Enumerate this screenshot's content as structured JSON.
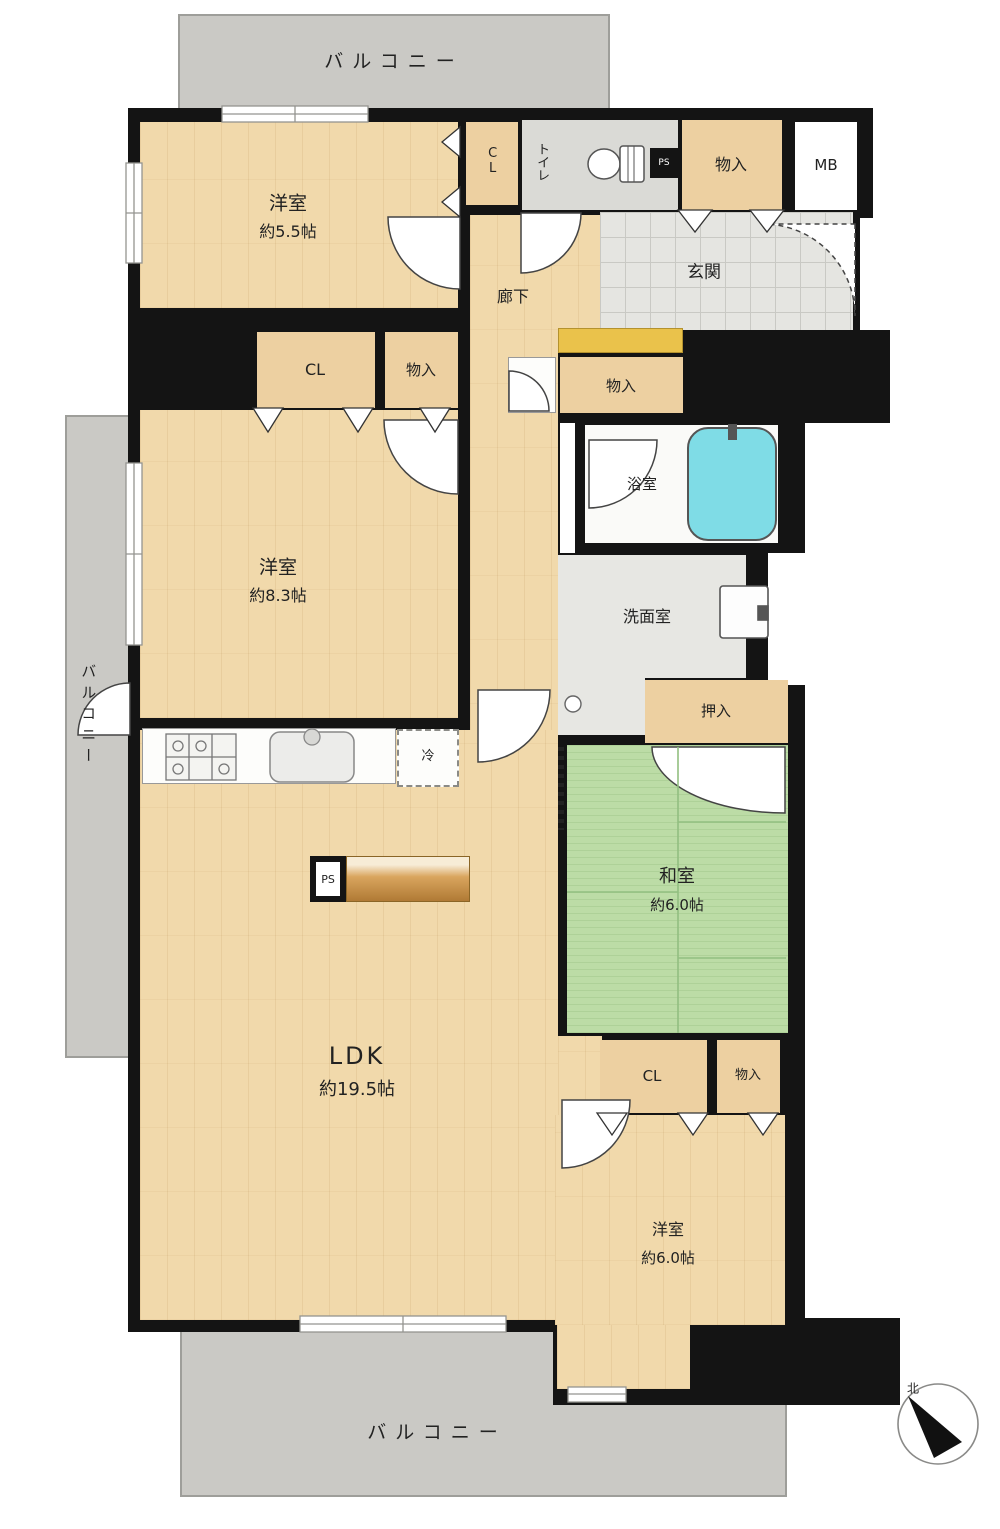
{
  "balconies": {
    "top": "バルコニー",
    "left": "バルコニー",
    "bottom": "バルコニー"
  },
  "rooms": {
    "western_5_5": {
      "label": "洋室",
      "size": "約5.5帖"
    },
    "western_8_3": {
      "label": "洋室",
      "size": "約8.3帖"
    },
    "western_6_0": {
      "label": "洋室",
      "size": "約6.0帖"
    },
    "japanese_6_0": {
      "label": "和室",
      "size": "約6.0帖"
    },
    "ldk": {
      "label": "LDK",
      "size": "約19.5帖"
    },
    "entrance": {
      "label": "玄関"
    },
    "hallway": {
      "label": "廊下"
    },
    "bathroom": {
      "label": "浴室"
    },
    "washroom": {
      "label": "洗面室"
    },
    "toilet": {
      "label": "トイレ"
    }
  },
  "storage": {
    "cl_small": "CL",
    "cl_west83": "CL",
    "cl_west60": "CL",
    "monoire_top": "物入",
    "monoire_hall": "物入",
    "monoire_west83": "物入",
    "monoire_west60": "物入",
    "oshiire": "押入",
    "mb": "MB"
  },
  "fixtures": {
    "fridge": "冷",
    "ps_kitchen": "PS",
    "ps_toilet": "PS"
  },
  "compass": {
    "north": "北"
  },
  "colors": {
    "wall": "#141414",
    "wood": "#f1d9ab",
    "closet": "#edd0a1",
    "tatami": "#bcdca6",
    "tile": "#e5e5e1",
    "balcony": "#cac9c5",
    "accent_step": "#eac24b",
    "tub": "#7fdce6"
  }
}
